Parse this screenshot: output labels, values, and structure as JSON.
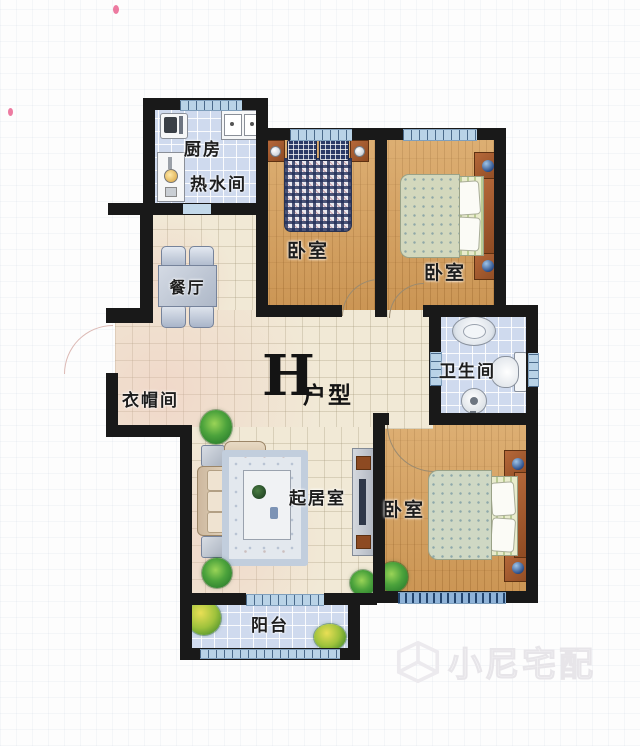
{
  "unit": {
    "letter": "H",
    "type": "户型"
  },
  "rooms": {
    "kitchen": "厨房",
    "water_heater_room": "热水间",
    "dining": "餐厅",
    "bedroom_top": "卧室",
    "bedroom_right": "卧室",
    "bedroom_bottom": "卧室",
    "bathroom": "卫生间",
    "cloakroom": "衣帽间",
    "living_room": "起居室",
    "balcony": "阳台"
  },
  "watermark": {
    "brand": "小尼宅配"
  },
  "colors": {
    "wall": "#191919",
    "wood_floor": "#d29d5b",
    "tile_floor": "#cfdaee",
    "hall_floor": "#f1e9d6",
    "window": "#b9d3e7",
    "furniture_blue": "#b9c4d6",
    "furniture_brown": "#a4592c"
  }
}
